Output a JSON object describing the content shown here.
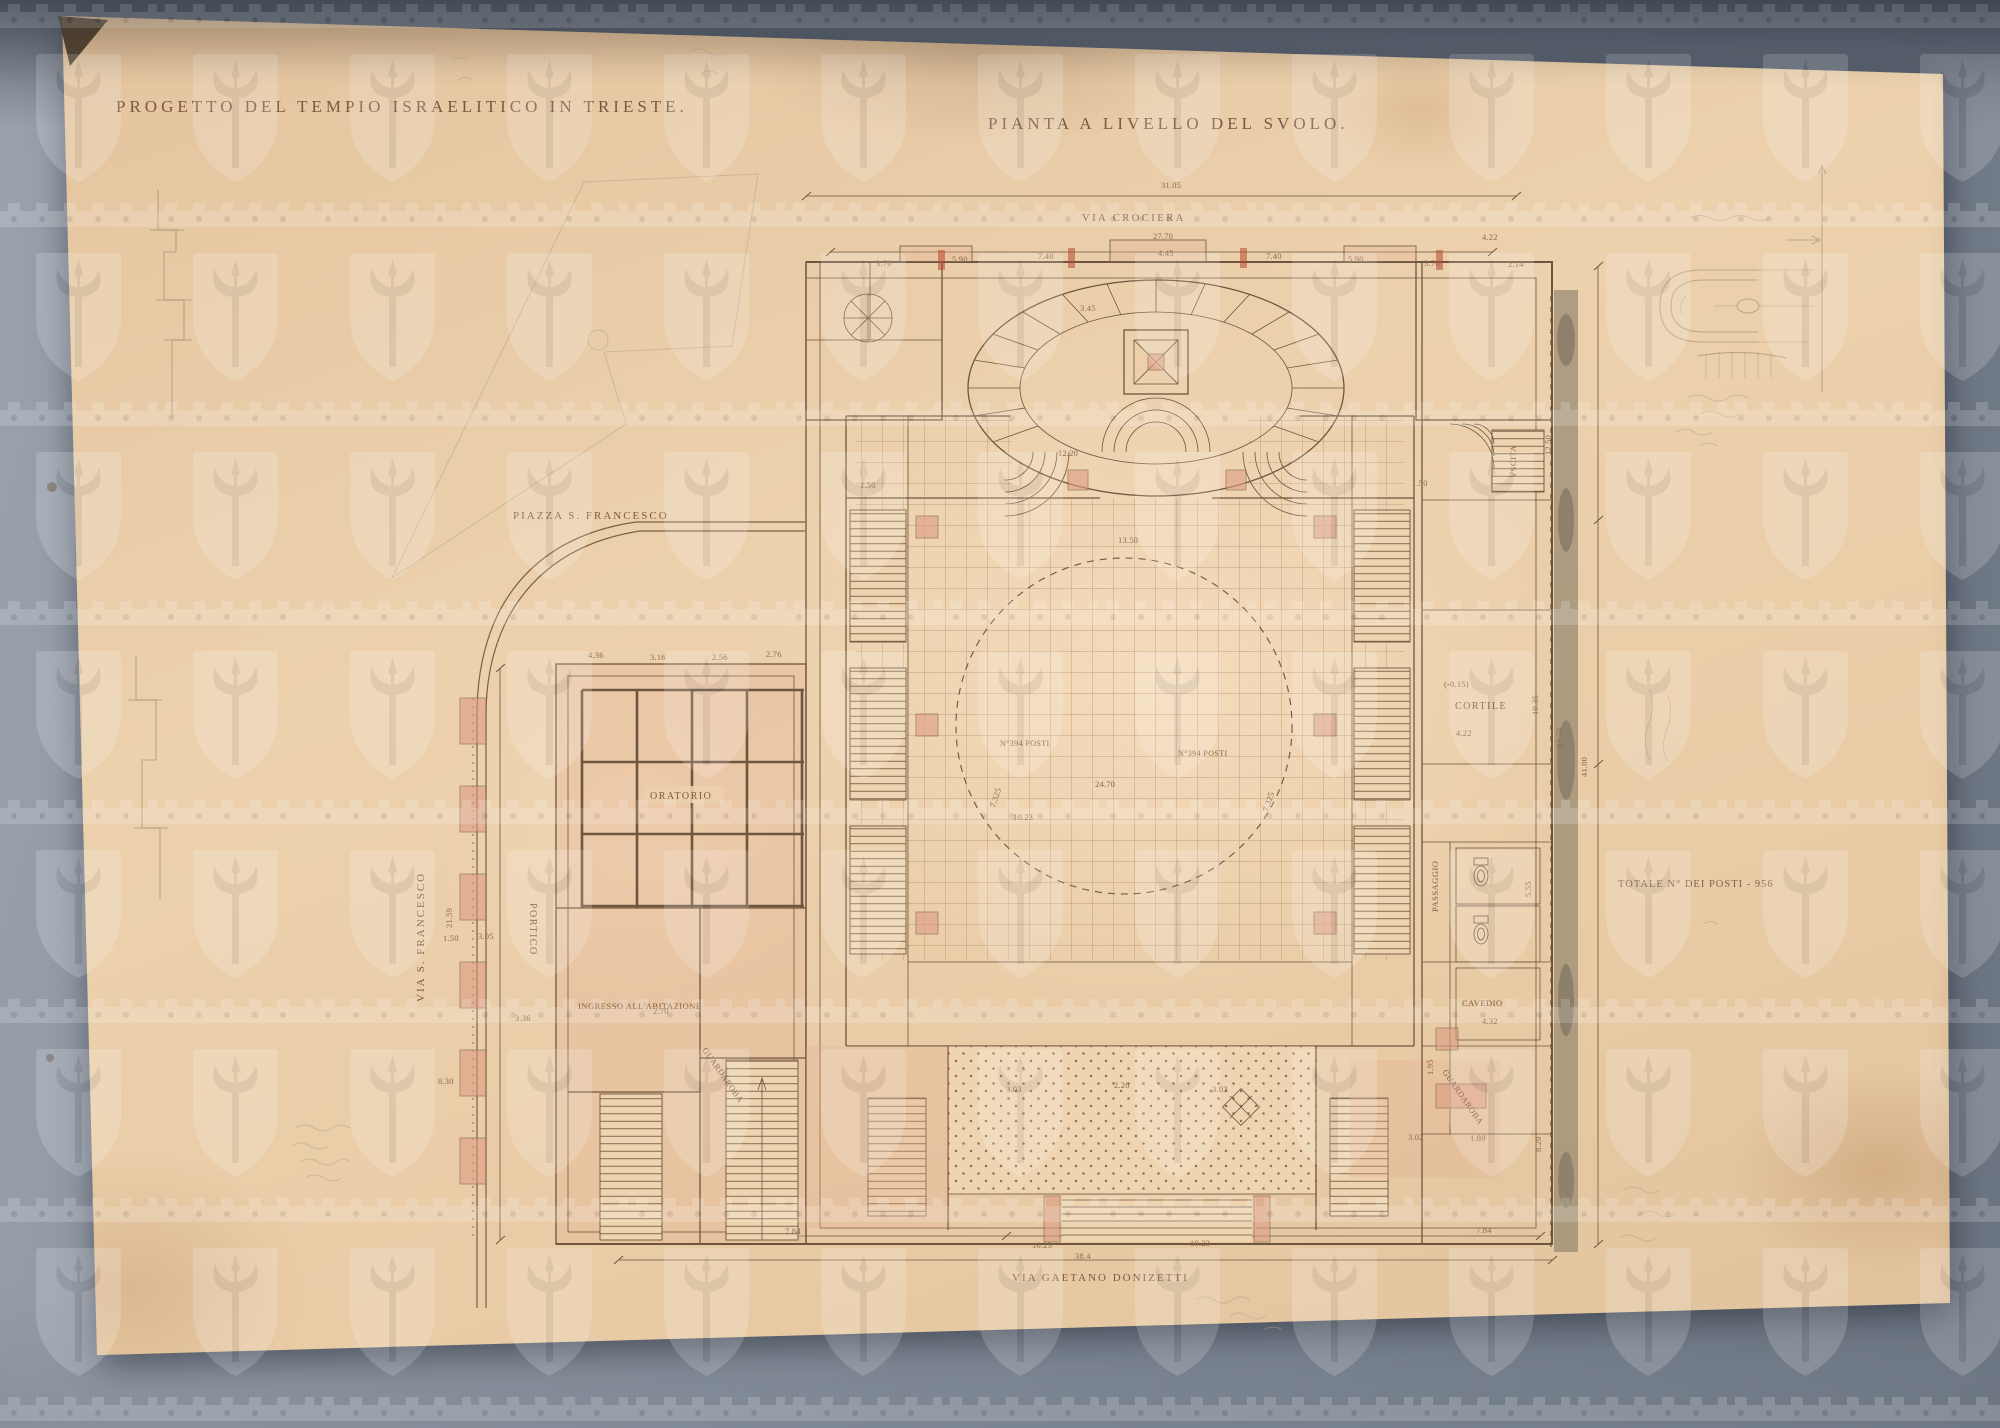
{
  "artwork": {
    "title_left": "PROGETTO DEL TEMPIO ISRAELITICO IN TRIESTE.",
    "title_right": "PIANTA A LIVELLO DEL SVOLO."
  },
  "streets": {
    "via_crociera": "VIA CROCIERA",
    "piazza_s_francesco": "PIAZZA S. FRANCESCO",
    "via_s_francesco": "VIA S. FRANCESCO",
    "via_gaetano_donizetti": "VIA GAETANO DONIZETTI"
  },
  "rooms": {
    "oratorio": "ORATORIO",
    "portico": "PORTICO",
    "ingresso": "INGRESSO ALL'ABITAZIONE",
    "guardaroba_left": "GUARDAROBA",
    "guardaroba_right": "GUARDAROBA",
    "cortile": "CORTILE",
    "passaggio": "PASSAGGIO",
    "cavedio": "CAVEDIO",
    "uscita": "VSCITA"
  },
  "annotations": {
    "totale_posti": "TOTALE N° DEI POSTI - 956",
    "posti_left": "N°394 POSTI",
    "posti_right": "N°394 POSTI"
  },
  "plan": {
    "dim_labels": [
      {
        "t": "31.05",
        "x": 1161,
        "y": 188
      },
      {
        "t": "27.70",
        "x": 1153,
        "y": 239
      },
      {
        "t": "3.70",
        "x": 876,
        "y": 266
      },
      {
        "t": "5.90",
        "x": 952,
        "y": 262
      },
      {
        "t": "7.40",
        "x": 1038,
        "y": 259
      },
      {
        "t": "4.45",
        "x": 1158,
        "y": 256
      },
      {
        "t": "7.40",
        "x": 1266,
        "y": 259
      },
      {
        "t": "5.90",
        "x": 1348,
        "y": 262
      },
      {
        "t": "3.70",
        "x": 1424,
        "y": 266
      },
      {
        "t": "4.22",
        "x": 1482,
        "y": 240
      },
      {
        "t": "2.14",
        "x": 1508,
        "y": 267
      },
      {
        "t": "3.45",
        "x": 1080,
        "y": 311
      },
      {
        "t": "12.20",
        "x": 1058,
        "y": 456
      },
      {
        "t": "1.50",
        "x": 860,
        "y": 488
      },
      {
        "t": "1.50",
        "x": 1412,
        "y": 486
      },
      {
        "t": "13.50",
        "x": 1118,
        "y": 543
      },
      {
        "t": "24.70",
        "x": 1095,
        "y": 787
      },
      {
        "t": "10.23",
        "x": 1013,
        "y": 820
      },
      {
        "t": "7.325",
        "x": 995,
        "y": 808,
        "r": -72
      },
      {
        "t": "7.325",
        "x": 1268,
        "y": 812,
        "r": -72
      },
      {
        "t": "4.36",
        "x": 588,
        "y": 658
      },
      {
        "t": "3.16",
        "x": 650,
        "y": 660
      },
      {
        "t": "2.56",
        "x": 712,
        "y": 660
      },
      {
        "t": "2.76",
        "x": 766,
        "y": 657
      },
      {
        "t": "21.59",
        "x": 452,
        "y": 928,
        "r": -90
      },
      {
        "t": "1.50",
        "x": 443,
        "y": 941
      },
      {
        "t": "3.05",
        "x": 478,
        "y": 939
      },
      {
        "t": "3.36",
        "x": 515,
        "y": 1021
      },
      {
        "t": "8.30",
        "x": 438,
        "y": 1084
      },
      {
        "t": "2.70",
        "x": 653,
        "y": 1014
      },
      {
        "t": "(-0.15)",
        "x": 1444,
        "y": 687
      },
      {
        "t": "4.22",
        "x": 1456,
        "y": 736
      },
      {
        "t": "10.35",
        "x": 1538,
        "y": 715,
        "r": -90
      },
      {
        "t": "12.50",
        "x": 1551,
        "y": 455,
        "r": -90
      },
      {
        "t": "27.70",
        "x": 1562,
        "y": 748,
        "r": -90
      },
      {
        "t": "41.00",
        "x": 1587,
        "y": 777,
        "r": -90
      },
      {
        "t": "5.55",
        "x": 1531,
        "y": 897,
        "r": -90
      },
      {
        "t": "1.95",
        "x": 1433,
        "y": 1075,
        "r": -90
      },
      {
        "t": "4.32",
        "x": 1482,
        "y": 1024
      },
      {
        "t": "3.02",
        "x": 1408,
        "y": 1140
      },
      {
        "t": "1.89",
        "x": 1470,
        "y": 1141
      },
      {
        "t": "8.20",
        "x": 1541,
        "y": 1152,
        "r": -90
      },
      {
        "t": "3.03",
        "x": 1006,
        "y": 1092
      },
      {
        "t": "2.20",
        "x": 1114,
        "y": 1088
      },
      {
        "t": "3.03",
        "x": 1212,
        "y": 1092
      },
      {
        "t": "7.84",
        "x": 785,
        "y": 1234
      },
      {
        "t": "10.23",
        "x": 1032,
        "y": 1248
      },
      {
        "t": "38.4",
        "x": 1075,
        "y": 1259
      },
      {
        "t": "10.23",
        "x": 1190,
        "y": 1246
      },
      {
        "t": "7.84",
        "x": 1476,
        "y": 1233
      }
    ]
  },
  "colors": {
    "mat": "#7b8492",
    "paper": "#ecd1ad",
    "ink": "#6f553e",
    "pencil": "#a18a6c",
    "poche_pink": "#dd9c82",
    "party_wall": "#948771"
  }
}
